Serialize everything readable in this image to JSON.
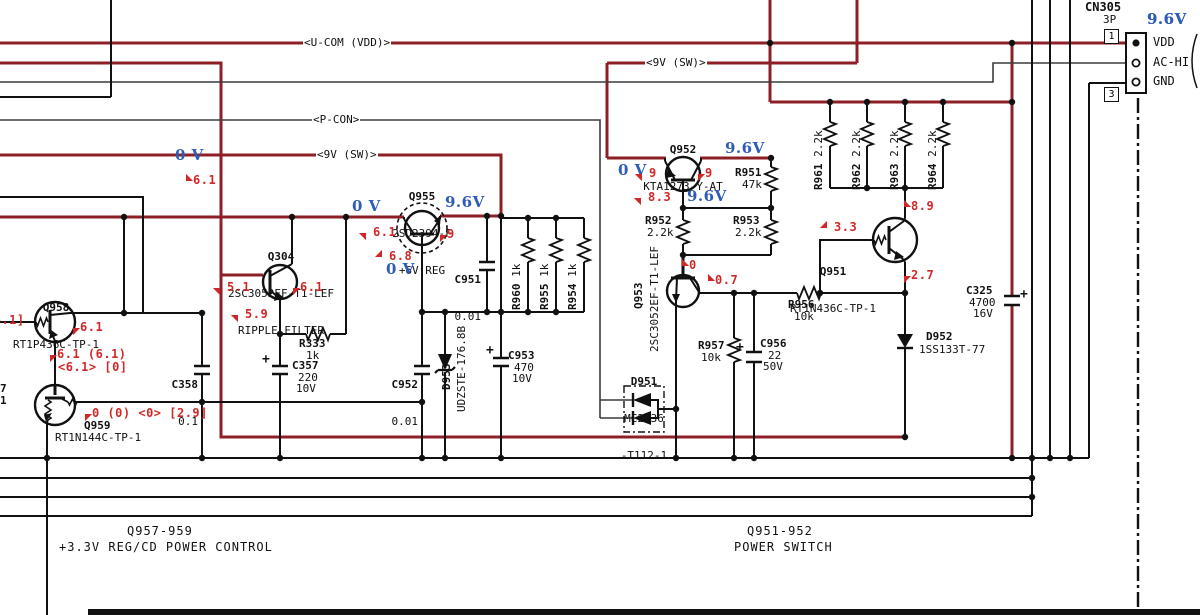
{
  "net_labels": {
    "u_com_vdd": "<U-COM (VDD)>",
    "p_con": "<P-CON>",
    "v9_sw_1": "<9V (SW)>",
    "v9_sw_2": "<9V (SW)>"
  },
  "connector": {
    "ref": "CN305",
    "type": "3P",
    "pin1_number": "1",
    "pin3_number": "3",
    "pin1_label": "VDD",
    "pin2_label": "AC-HI",
    "pin3_label": "GND",
    "voltage": "9.6V"
  },
  "section_labels": {
    "left_refs": "Q957-959",
    "left_title": "+3.3V REG/CD POWER CONTROL",
    "right_refs": "Q951-952",
    "right_title": "POWER SWITCH"
  },
  "components": {
    "q304": {
      "ref": "Q304",
      "part": "2SC3052EF-T1-LEF",
      "role": "RIPPLE FILTER"
    },
    "q955": {
      "ref": "Q955",
      "part": "2SD2394-F",
      "role": "+6V REG"
    },
    "q952": {
      "ref": "Q952",
      "part": "KTA1273-Y-AT"
    },
    "q951": {
      "ref": "Q951",
      "part": "RT1N436C-TP-1"
    },
    "q953": {
      "ref": "Q953",
      "part": "2SC3052EF-T1-LEF"
    },
    "q958": {
      "ref": "Q958",
      "part": "RT1P436C-TP-1"
    },
    "q959": {
      "ref": "Q959",
      "part": "RT1N144C-TP-1"
    },
    "d951": {
      "ref": "D951",
      "part_line1": "MC2836",
      "part_line2": "-T112-1"
    },
    "d952": {
      "ref": "D952",
      "part": "1SS133T-77"
    },
    "d953": {
      "ref": "D953",
      "part": "UDZSTE-176.8B"
    },
    "r333": {
      "ref": "R333",
      "value": "1k"
    },
    "r951": {
      "ref": "R951",
      "value": "47k"
    },
    "r952": {
      "ref": "R952",
      "value": "2.2k"
    },
    "r953": {
      "ref": "R953",
      "value": "2.2k"
    },
    "r956": {
      "ref": "R956",
      "value": "10k"
    },
    "r957": {
      "ref": "R957",
      "value": "10k"
    },
    "r960": {
      "ref": "R960",
      "value": "1k"
    },
    "r955": {
      "ref": "R955",
      "value": "1k"
    },
    "r954": {
      "ref": "R954",
      "value": "1k"
    },
    "r961": {
      "ref": "R961",
      "value": "2.2k"
    },
    "r962": {
      "ref": "R962",
      "value": "2.2k"
    },
    "r963": {
      "ref": "R963",
      "value": "2.2k"
    },
    "r964": {
      "ref": "R964",
      "value": "2.2k"
    },
    "c951": {
      "ref": "C951",
      "value": "0.01"
    },
    "c952": {
      "ref": "C952",
      "value": "0.01"
    },
    "c953": {
      "ref": "C953",
      "value": "470",
      "voltage": "10V"
    },
    "c956": {
      "ref": "C956",
      "value": "22",
      "voltage": "50V"
    },
    "c357": {
      "ref": "C357",
      "value": "220",
      "voltage": "10V"
    },
    "c358": {
      "ref": "C358",
      "value": "0.1"
    },
    "c325": {
      "ref": "C325",
      "value": "4700",
      "voltage": "16V"
    }
  },
  "symbols": {
    "plus": "+"
  },
  "voltage_annotations": {
    "blue": [
      {
        "x": 1147,
        "y": 10,
        "text": "9.6V"
      },
      {
        "x": 725,
        "y": 139,
        "text": "9.6V"
      },
      {
        "x": 687,
        "y": 187,
        "text": "9.6V"
      },
      {
        "x": 618,
        "y": 161,
        "text": "0 V"
      },
      {
        "x": 175,
        "y": 146,
        "text": "0 V"
      },
      {
        "x": 352,
        "y": 197,
        "text": "0 V"
      },
      {
        "x": 445,
        "y": 193,
        "text": "9.6V"
      },
      {
        "x": 386,
        "y": 260,
        "text": "0 V"
      }
    ],
    "red": [
      {
        "x": 193,
        "y": 173,
        "text": "6.1",
        "arrow": "dl"
      },
      {
        "x": 227,
        "y": 280,
        "text": "5.1",
        "arrow": "ur"
      },
      {
        "x": 300,
        "y": 280,
        "text": "6.1",
        "arrow": "ul"
      },
      {
        "x": 245,
        "y": 307,
        "text": "5.9",
        "arrow": "ur"
      },
      {
        "x": 373,
        "y": 225,
        "text": "6.1",
        "arrow": "ur"
      },
      {
        "x": 447,
        "y": 227,
        "text": "9",
        "arrow": "ul"
      },
      {
        "x": 389,
        "y": 249,
        "text": "6.8",
        "arrow": "dr"
      },
      {
        "x": 649,
        "y": 166,
        "text": "9",
        "arrow": "ur"
      },
      {
        "x": 705,
        "y": 166,
        "text": "9",
        "arrow": "ul"
      },
      {
        "x": 648,
        "y": 190,
        "text": "8.3",
        "arrow": "ur"
      },
      {
        "x": 689,
        "y": 258,
        "text": "0",
        "arrow": "dl"
      },
      {
        "x": 715,
        "y": 273,
        "text": "0.7",
        "arrow": "dl"
      },
      {
        "x": 834,
        "y": 220,
        "text": "3.3",
        "arrow": "dr"
      },
      {
        "x": 911,
        "y": 199,
        "text": "8.9",
        "arrow": "dl"
      },
      {
        "x": 911,
        "y": 268,
        "text": "2.7",
        "arrow": "ul"
      },
      {
        "x": 80,
        "y": 320,
        "text": "6.1",
        "arrow": "ul"
      },
      {
        "x": -14,
        "y": 313,
        "text": "[6.1]",
        "arrow": ""
      },
      {
        "x": 57,
        "y": 347,
        "text": "6.1 (6.1)",
        "arrow": "ul"
      },
      {
        "x": 58,
        "y": 360,
        "text": "<6.1> [0]",
        "arrow": ""
      },
      {
        "x": 92,
        "y": 406,
        "text": "0 (0) <0> [2.9]",
        "arrow": "ul"
      }
    ],
    "black_partials": [
      {
        "x": 0,
        "y": 382,
        "text": "7"
      },
      {
        "x": 0,
        "y": 394,
        "text": "1"
      }
    ]
  }
}
